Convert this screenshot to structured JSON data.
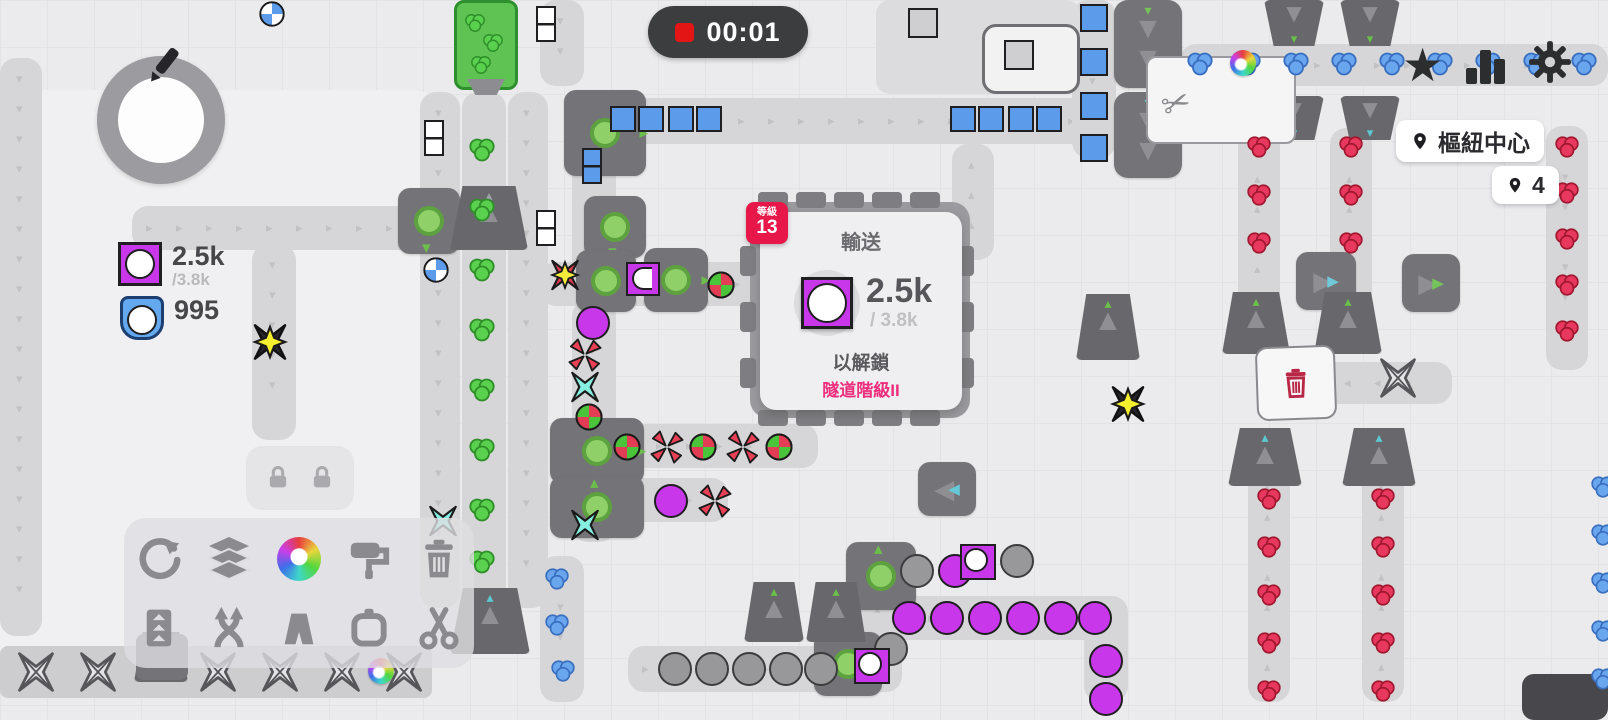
{
  "hud": {
    "timer": {
      "value": "00:01",
      "icon": "record-square-icon"
    },
    "draw_button": {
      "icon": "pencil-icon"
    },
    "topbar_icons": [
      {
        "id": "favorites",
        "icon": "star-icon"
      },
      {
        "id": "statistics",
        "icon": "bar-chart-icon"
      },
      {
        "id": "settings",
        "icon": "gear-icon"
      }
    ],
    "markers": [
      {
        "label": "樞紐中心",
        "icon": "pin-icon"
      },
      {
        "label": "4",
        "icon": "pin-icon"
      }
    ],
    "resources": [
      {
        "shape": "purple-circle-shape",
        "value": "2.5k",
        "target": "/3.8k"
      },
      {
        "shape": "blue-circle-shape",
        "value": "995",
        "target": ""
      }
    ]
  },
  "goal_popup": {
    "level_badge": {
      "label": "等級",
      "value": "13"
    },
    "title": "輸送",
    "shape": "purple-circle-shape",
    "current": "2.5k",
    "target": "/ 3.8k",
    "unlock_text": "以解鎖",
    "reward": "隧道階級II",
    "accent_color": "#e8174a",
    "reward_color": "#ee2d7c"
  },
  "toolbar": {
    "locked_slots": 2,
    "row1": [
      {
        "id": "rotate",
        "icon": "rotate-icon"
      },
      {
        "id": "layers",
        "icon": "layers-icon"
      },
      {
        "id": "colors",
        "icon": "color-wheel-icon"
      },
      {
        "id": "painter",
        "icon": "paint-roller-icon"
      },
      {
        "id": "delete",
        "icon": "trash-icon"
      }
    ],
    "row2": [
      {
        "id": "lift",
        "icon": "belt-lift-icon"
      },
      {
        "id": "swapper",
        "icon": "crossed-arrows-icon"
      },
      {
        "id": "tunnel",
        "icon": "tunnel-icon"
      },
      {
        "id": "frame",
        "icon": "frame-icon"
      },
      {
        "id": "cutter",
        "icon": "scissors-icon"
      }
    ]
  },
  "colors": {
    "belt": "#d6d6d8",
    "machine": "#747478",
    "purple": "#c837ea",
    "blue_item": "#5b9bea",
    "green_item": "#57d14e",
    "red_item": "#e8385e",
    "timer_bg": "#3c3d3f",
    "badge_red": "#e8174a"
  }
}
